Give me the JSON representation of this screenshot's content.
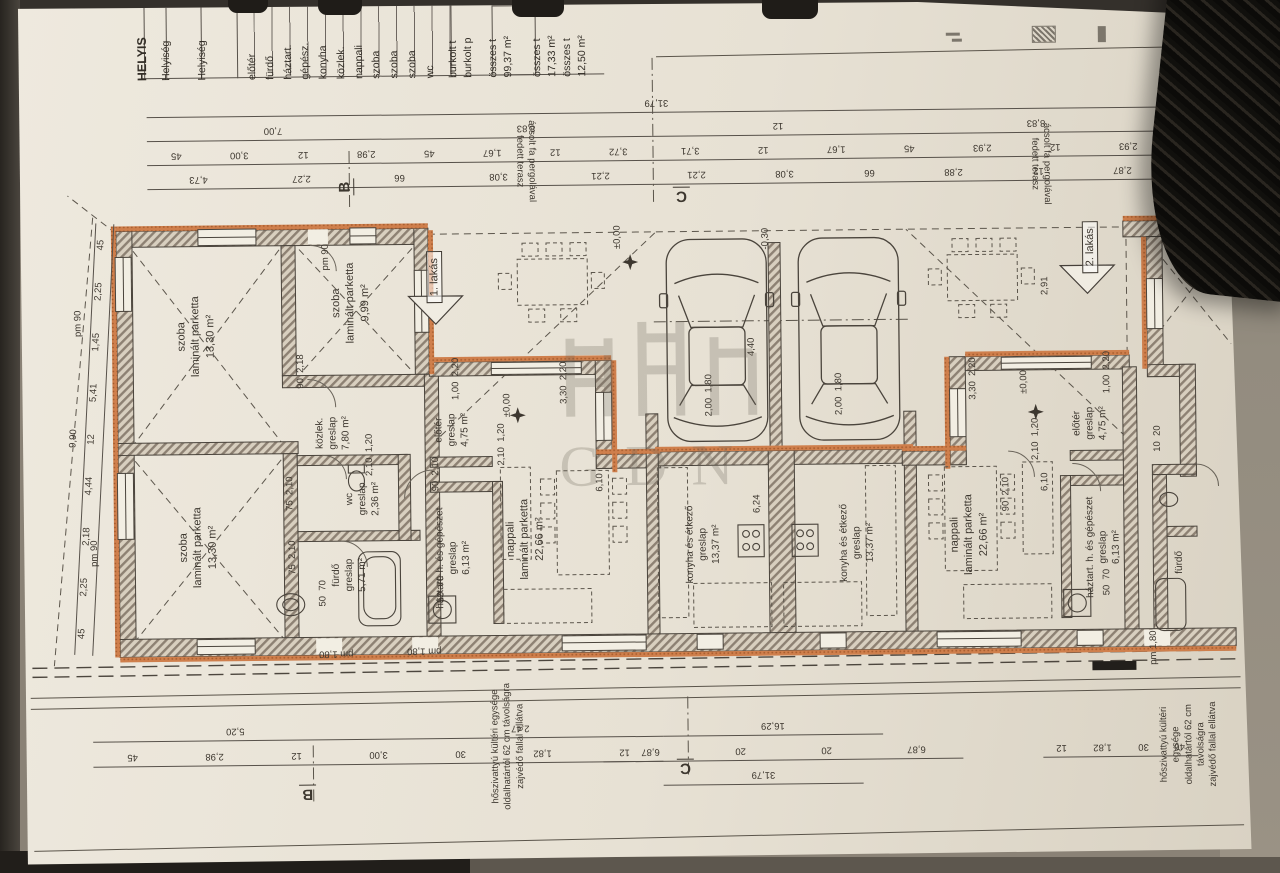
{
  "sheet": {
    "schedule": {
      "items": [
        {
          "t": "HELYIS",
          "x": 152,
          "y": 64,
          "cls": "big"
        },
        {
          "t": "Helyiség",
          "x": 176,
          "y": 64
        },
        {
          "t": "Helyiség",
          "x": 212,
          "y": 64
        },
        {
          "t": "előtér",
          "x": 262,
          "y": 64
        },
        {
          "t": "fürdő",
          "x": 280,
          "y": 64
        },
        {
          "t": "háztart.",
          "x": 298,
          "y": 64
        },
        {
          "t": "gépész.",
          "x": 315,
          "y": 64
        },
        {
          "t": "konyha",
          "x": 333,
          "y": 64
        },
        {
          "t": "közlek.",
          "x": 351,
          "y": 64
        },
        {
          "t": "nappali",
          "x": 369,
          "y": 64
        },
        {
          "t": "szoba",
          "x": 386,
          "y": 64
        },
        {
          "t": "szoba",
          "x": 404,
          "y": 64
        },
        {
          "t": "szoba",
          "x": 422,
          "y": 64
        },
        {
          "t": "wc",
          "x": 440,
          "y": 64
        },
        {
          "t": "burkolt t",
          "x": 463,
          "y": 64
        },
        {
          "t": "burkolt p",
          "x": 478,
          "y": 64
        },
        {
          "t": "összes t",
          "x": 503,
          "y": 64
        },
        {
          "t": "99,37 m²",
          "x": 518,
          "y": 64
        },
        {
          "t": "összes t",
          "x": 547,
          "y": 64
        },
        {
          "t": "17,33 m²",
          "x": 562,
          "y": 64
        },
        {
          "t": "összes t",
          "x": 577,
          "y": 64
        },
        {
          "t": "12,50 m²",
          "x": 592,
          "y": 64
        }
      ]
    },
    "dim_rows": [
      {
        "x": 150,
        "y": 98,
        "w": 1020,
        "labels": [
          "31,79"
        ]
      },
      {
        "x": 150,
        "y": 122,
        "w": 505,
        "labels": [
          "7,00",
          "8,83"
        ]
      },
      {
        "x": 655,
        "y": 122,
        "w": 515,
        "labels": [
          "12",
          "8,83"
        ]
      },
      {
        "x": 150,
        "y": 146,
        "w": 505,
        "labels": [
          "45",
          "3,00",
          "12",
          "2,98",
          "45",
          "1,67",
          "12",
          "3,72"
        ]
      },
      {
        "x": 655,
        "y": 146,
        "w": 515,
        "labels": [
          "3,71",
          "12",
          "1,67",
          "45",
          "2,93",
          "12",
          "2,93"
        ]
      },
      {
        "x": 150,
        "y": 170,
        "w": 505,
        "labels": [
          "4,73",
          "2,27",
          "66",
          "3,08",
          "2,21"
        ]
      },
      {
        "x": 655,
        "y": 170,
        "w": 515,
        "labels": [
          "2,21",
          "3,08",
          "66",
          "2,88",
          "12",
          "2,87"
        ]
      },
      {
        "x": 90,
        "y": 722,
        "w": 570,
        "labels": [
          "5,20",
          "2,47"
        ]
      },
      {
        "x": 660,
        "y": 722,
        "w": 220,
        "labels": [
          "16,29"
        ]
      },
      {
        "x": 90,
        "y": 747,
        "w": 570,
        "labels": [
          "45",
          "2,98",
          "12",
          "3,00",
          "30",
          "1,82",
          "12"
        ]
      },
      {
        "x": 600,
        "y": 747,
        "w": 360,
        "labels": [
          "6,87",
          "20",
          "20",
          "6,87"
        ]
      },
      {
        "x": 1040,
        "y": 747,
        "w": 155,
        "labels": [
          "12",
          "1,82",
          "30",
          "46"
        ]
      },
      {
        "x": 660,
        "y": 771,
        "w": 200,
        "labels": [
          "31,79"
        ]
      }
    ],
    "left_chain": {
      "rows": [
        {
          "labels": [
            "9,90"
          ]
        },
        {
          "labels": [
            "45",
            "2,25",
            "2,18",
            "4,44",
            "12",
            "5,41",
            "1,45",
            "2,25",
            "45"
          ]
        }
      ]
    },
    "rooms": [
      {
        "x": 197,
        "y": 332,
        "lines": [
          "szoba",
          "laminált parketta",
          "13,30 m²"
        ]
      },
      {
        "x": 352,
        "y": 300,
        "lines": [
          "szoba",
          "laminált parketta",
          "9,99 m²"
        ]
      },
      {
        "x": 197,
        "y": 543,
        "lines": [
          "szoba",
          "laminált parketta",
          "13,30 m²"
        ]
      },
      {
        "x": 333,
        "y": 430,
        "lines": [
          "közlek.",
          "greslap",
          "7,80 m²"
        ],
        "cls": "sm"
      },
      {
        "x": 362,
        "y": 496,
        "lines": [
          "wc",
          "greslap",
          "2,36 m²"
        ],
        "cls": "sm"
      },
      {
        "x": 348,
        "y": 572,
        "lines": [
          "fürdő",
          "greslap",
          "5,71 m²"
        ],
        "cls": "sm"
      },
      {
        "x": 452,
        "y": 428,
        "lines": [
          "előtér",
          "greslap",
          "4,75 m²"
        ],
        "cls": "sm"
      },
      {
        "x": 452,
        "y": 556,
        "lines": [
          "háztart. h. és gépészet",
          "greslap",
          "6,13 m²"
        ],
        "cls": "sm"
      },
      {
        "x": 524,
        "y": 538,
        "lines": [
          "nappali",
          "laminált parketta",
          "22,66 m²"
        ]
      },
      {
        "x": 702,
        "y": 545,
        "lines": [
          "konyha és étkező",
          "greslap",
          "13,37 m²"
        ],
        "cls": "sm"
      },
      {
        "x": 856,
        "y": 545,
        "lines": [
          "konyha és étkező",
          "greslap",
          "13,37 m²"
        ],
        "cls": "sm"
      },
      {
        "x": 968,
        "y": 538,
        "lines": [
          "nappali",
          "laminált parketta",
          "22,66 m²"
        ]
      },
      {
        "x": 1090,
        "y": 428,
        "lines": [
          "előtér",
          "greslap",
          "4,75 m²"
        ],
        "cls": "sm"
      },
      {
        "x": 1102,
        "y": 552,
        "lines": [
          "háztart. h. és gépészet",
          "greslap",
          "6,13 m²"
        ],
        "cls": "sm"
      },
      {
        "x": 1178,
        "y": 568,
        "lines": [
          "fürdő"
        ],
        "cls": "sm"
      }
    ],
    "annotations": [
      {
        "t": "pm 90",
        "x": 80,
        "y": 318,
        "r": -90
      },
      {
        "t": "pm 90",
        "x": 94,
        "y": 548,
        "r": -90
      },
      {
        "t": "pm 90",
        "x": 328,
        "y": 254,
        "r": -90
      },
      {
        "t": "90  2,18",
        "x": 302,
        "y": 368,
        "r": -90
      },
      {
        "t": "90  2,10",
        "x": 436,
        "y": 472,
        "r": -90
      },
      {
        "t": "90  2,10",
        "x": 1006,
        "y": 498,
        "r": -90
      },
      {
        "t": "2,10  1,20",
        "x": 370,
        "y": 452,
        "r": -90
      },
      {
        "t": "2,10  1,20",
        "x": 502,
        "y": 443,
        "r": -90
      },
      {
        "t": "2,10  1,20",
        "x": 1036,
        "y": 443,
        "r": -90
      },
      {
        "t": "3,30  2,20",
        "x": 565,
        "y": 382,
        "r": -90
      },
      {
        "t": "3,30  2,20",
        "x": 974,
        "y": 382,
        "r": -90
      },
      {
        "t": "1,00  2,20",
        "x": 457,
        "y": 377,
        "r": -90
      },
      {
        "t": "1,00  2,20",
        "x": 1108,
        "y": 377,
        "r": -90
      },
      {
        "t": "4,40",
        "x": 753,
        "y": 348,
        "r": -90
      },
      {
        "t": "-0,30",
        "x": 768,
        "y": 240,
        "r": -90
      },
      {
        "t": "±0,00",
        "x": 620,
        "y": 237,
        "r": -90
      },
      {
        "t": "±0,00",
        "x": 508,
        "y": 404,
        "r": -90
      },
      {
        "t": "±0,00",
        "x": 1025,
        "y": 386,
        "r": -90
      },
      {
        "t": "2,00  1,80",
        "x": 710,
        "y": 396,
        "r": -90
      },
      {
        "t": "2,00  1,80",
        "x": 840,
        "y": 396,
        "r": -90
      },
      {
        "t": "6,24",
        "x": 757,
        "y": 505,
        "r": -90
      },
      {
        "t": "6,10",
        "x": 600,
        "y": 482,
        "r": -90
      },
      {
        "t": "6,10",
        "x": 1045,
        "y": 486,
        "r": -90
      },
      {
        "t": "75  2,10",
        "x": 290,
        "y": 490,
        "r": -90
      },
      {
        "t": "75  2,10",
        "x": 292,
        "y": 554,
        "r": -90
      },
      {
        "t": "50  70",
        "x": 322,
        "y": 590,
        "r": -90
      },
      {
        "t": "50  70",
        "x": 440,
        "y": 587,
        "r": -90
      },
      {
        "t": "50  70",
        "x": 1106,
        "y": 587,
        "r": -90
      },
      {
        "t": "10  20",
        "x": 1158,
        "y": 444,
        "r": -90
      },
      {
        "t": "2,91",
        "x": 1047,
        "y": 290,
        "r": -90
      },
      {
        "t": "pm 1,80",
        "x": 334,
        "y": 650,
        "r": 180
      },
      {
        "t": "pm 1,80",
        "x": 422,
        "y": 648,
        "r": 180
      },
      {
        "t": "pm 1,80",
        "x": 1152,
        "y": 653,
        "r": -90
      }
    ],
    "axis_markers": [
      {
        "t": "B",
        "x": 348,
        "y": 184,
        "r": -90
      },
      {
        "t": "C",
        "x": 684,
        "y": 196,
        "r": 180
      },
      {
        "t": "B",
        "x": 304,
        "y": 790,
        "r": 180
      },
      {
        "t": "C",
        "x": 682,
        "y": 768,
        "r": 180
      }
    ],
    "units": [
      {
        "label": "1. lakás"
      },
      {
        "label": "2. lakás"
      }
    ],
    "notes": {
      "pergola": "ácsolt fa pergolával\nfedett terasz",
      "heatpump": "hőszivattyú kültéri egysége\noldalhatártól 62 cm távolságra\nzajvédő fallal ellátva"
    },
    "watermark": {
      "text": "GDN"
    },
    "colors": {
      "wall_hatch": "#8d8173",
      "insulation": "#cf7f4c",
      "ink": "#46403a",
      "paper": "#e9e3d6"
    }
  }
}
